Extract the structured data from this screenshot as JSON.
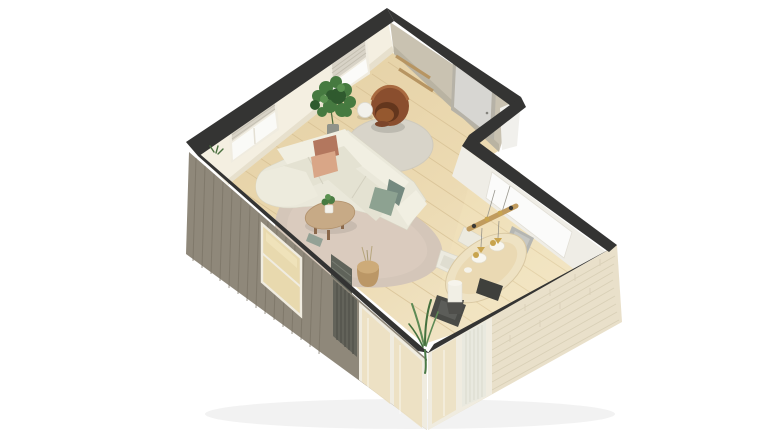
{
  "scene": {
    "title": "3D isometric cutaway floor plan render",
    "rooms": [
      {
        "name": "living-room",
        "items": [
          "l-shaped-sofa",
          "pillows",
          "coffee-table",
          "large-rug",
          "round-rug",
          "swivel-armchair",
          "side-table",
          "fiddle-leaf-plant",
          "wall-shelves",
          "interior-door",
          "window-with-blinds",
          "window-with-blinds-2",
          "radiator",
          "basket",
          "bench-tray"
        ]
      },
      {
        "name": "dining-nook",
        "items": [
          "oval-dining-table",
          "place-settings",
          "white-chairs",
          "gray-chair",
          "dark-chairs",
          "pendant-light-bar",
          "floor-lamp-on-stool",
          "corner-plant",
          "glass-walls",
          "brick-wall",
          "wall-opening"
        ]
      }
    ]
  },
  "palette": {
    "wall-top": "#343433",
    "wall-cream": "#f4efe1",
    "wall-greige": "#c9c2b1",
    "wall-white": "#f1f0ec",
    "floor-wood": "#ead8b0",
    "floor-line": "#d4bd90",
    "ext-wood": "#8f887a",
    "ext-wood-line": "#7b7466",
    "brick": "#e9e0ca",
    "brick-line": "#d9d0b7",
    "glass": "#eff0e9",
    "glass-floor": "#ecdfbd",
    "frame": "#f0ece0",
    "sofa": "#eae8da",
    "sofa-seat": "#e4e2d2",
    "sofa-back": "#f1efe2",
    "pillow-rust": "#b3775e",
    "pillow-peach": "#d9a687",
    "pillow-sage": "#8da291",
    "pillow-teal": "#74897f",
    "rug-large": "#d4c6b9",
    "rug-round": "#d8d4c9",
    "armchair": "#8a4e2e",
    "armchair-dark": "#63361d",
    "plant": "#467a40",
    "plant-dark": "#2f5a2e",
    "pot": "#90938a",
    "wood-table": "#c7aa86",
    "wood-leg": "#8a684b",
    "table-cream": "#eee2c3",
    "table-center": "#e8d6ad",
    "chair-white": "#eceadf",
    "chair-gray": "#b5b6b2",
    "chair-dark": "#4a4b47",
    "pendant-wood": "#c09b5e",
    "gold": "#c8a44e",
    "radiator": "#5f635a",
    "basket": "#bb9766",
    "blinds": "#d8d3c7",
    "shelf-wood": "#b79562",
    "door-panel": "#d7d6d2",
    "door-frame": "#b6b2a7"
  }
}
